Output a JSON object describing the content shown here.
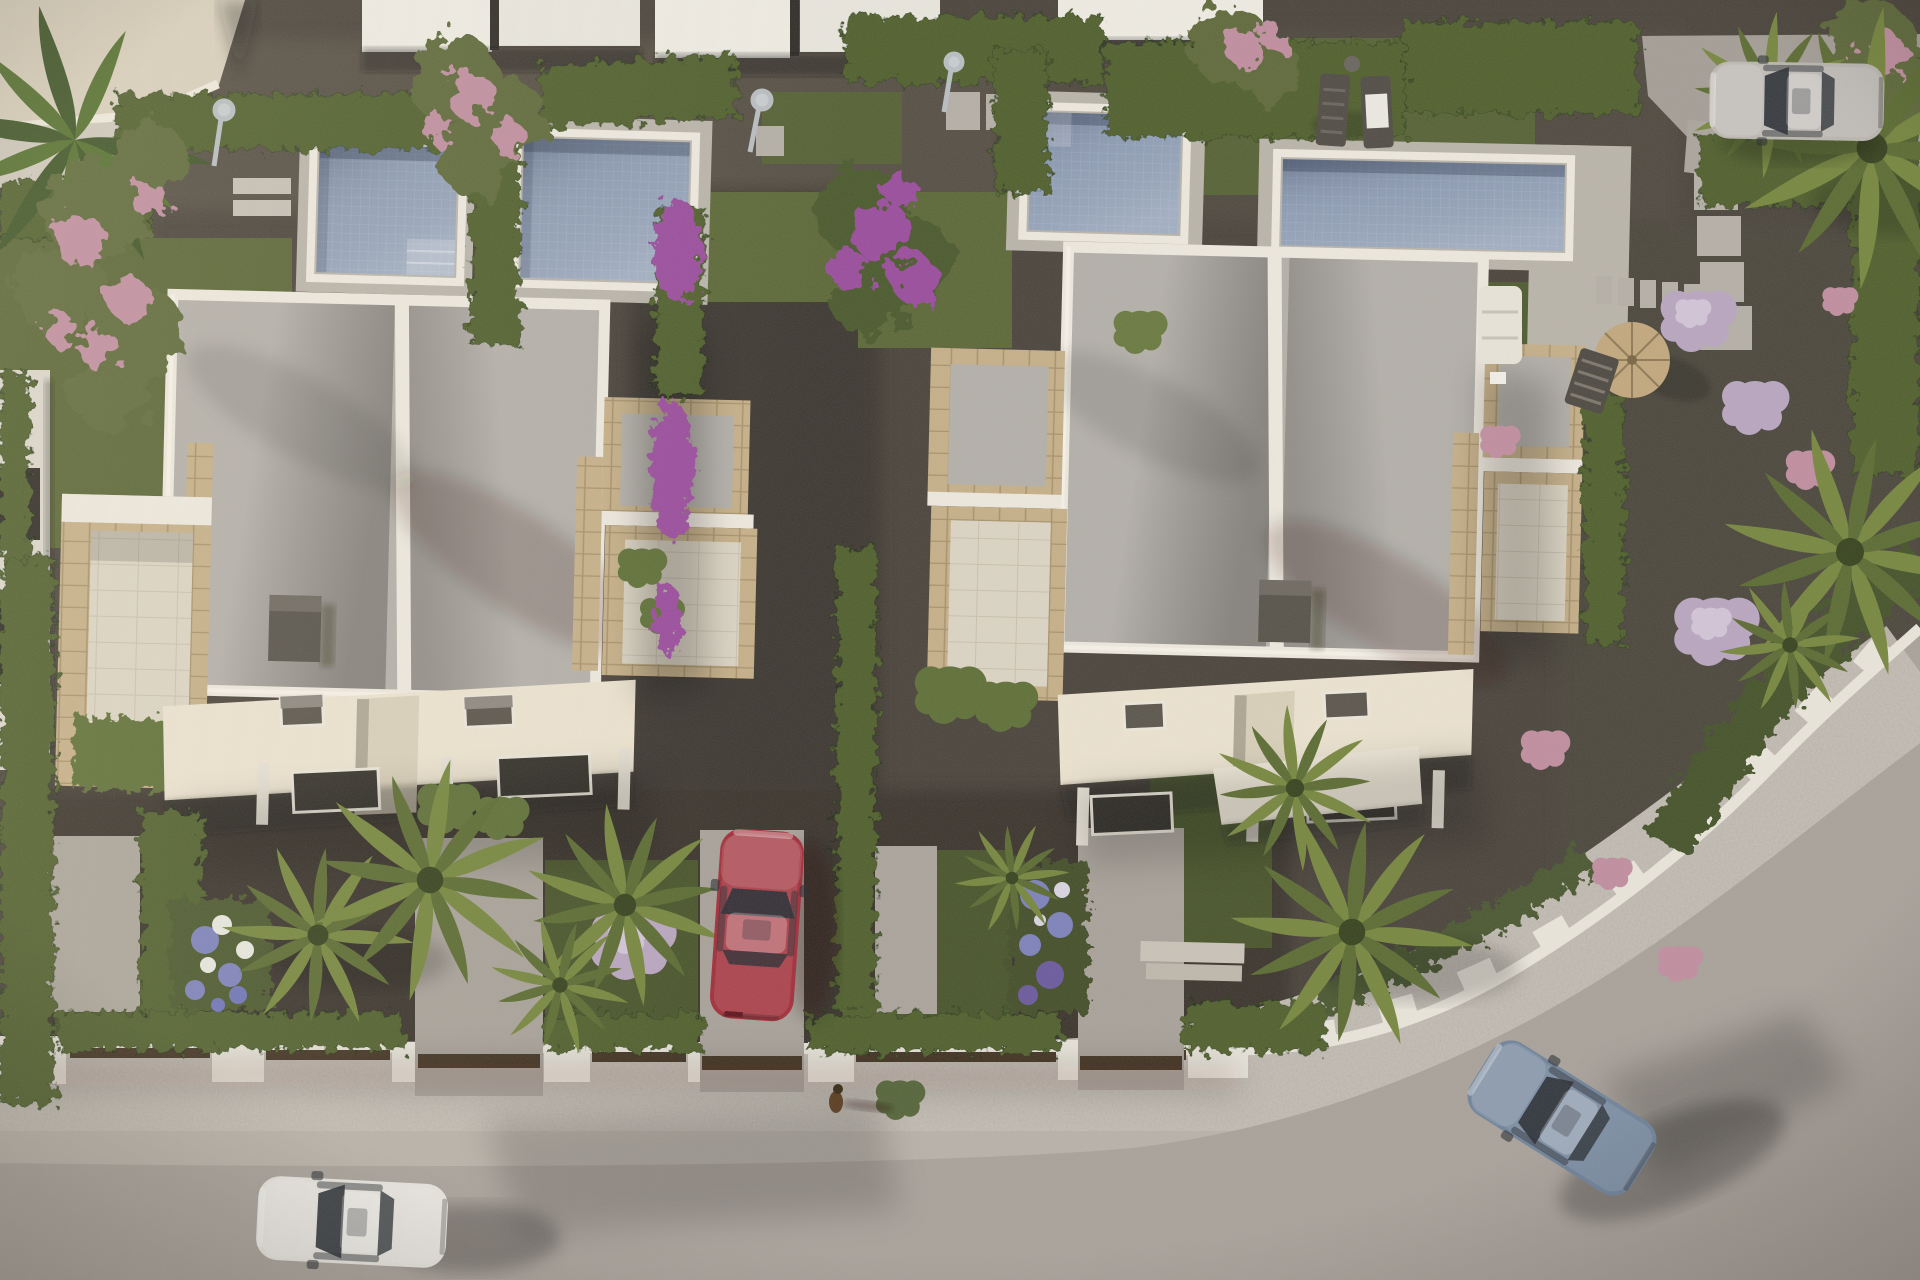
{
  "scene": {
    "title": "Aerial top-down 3D render of a modern villa development",
    "description": "Bird's-eye architectural rendering: two white duplex villas with flat gravel roofs, four swimming pools, Mediterranean gardens, parked cars, and a curved road with sidewalk along the bottom and right",
    "objects": {
      "villas": [
        "left duplex villa",
        "right duplex villa"
      ],
      "pools": [
        "pool-1",
        "pool-2",
        "pool-3",
        "pool-4"
      ],
      "cars": [
        {
          "id": "white-car",
          "location": "road bottom left",
          "color": "#e9e6e0"
        },
        {
          "id": "red-car",
          "location": "center driveway",
          "color": "#a32f3a"
        },
        {
          "id": "blue-car",
          "location": "road bottom right",
          "color": "#70839b"
        },
        {
          "id": "silver-car",
          "location": "top right driveway",
          "color": "#bab6b0"
        }
      ],
      "furniture": [
        "sun loungers",
        "wicker parasol",
        "deck chair",
        "garden sofa",
        "stepping stones",
        "outdoor showers"
      ],
      "landscape": [
        "cypress hedges",
        "fan palms",
        "banana plant",
        "bougainvillea",
        "pink flowering trees",
        "hydrangea beds",
        "gravel gardens",
        "lawns"
      ],
      "street": [
        "curved road",
        "speckled sidewalk",
        "white boundary wall",
        "dark timber gates"
      ],
      "figures": [
        "small dog on sidewalk"
      ]
    }
  },
  "palette": {
    "gravel_base": "#4a443c",
    "gravel_light": "#57504546",
    "gravel_path": "#3e3932",
    "road": "#a9a29b",
    "sidewalk": "#b8b2a9",
    "wall_white": "#e9e5db",
    "roof_gravel": "#b4b0aa",
    "parapet_white": "#eee9df",
    "cream_slab": "#ece3d0",
    "travertine": "#dcd5c5",
    "sandstone": "#c6b089",
    "pool_deck": "#bab5ab",
    "pool_water": "#8d9cb4",
    "grass": "#5a6636",
    "grass_dark": "#49552c",
    "hedge_green": "#51602f",
    "palm_green": "#77873f",
    "white_car": "#e9e6e0",
    "red_car": "#a32f3a",
    "blue_car": "#70839b",
    "silver_car": "#bab6b0",
    "gate_brown": "#463625",
    "flower_purple": "#9a4d9d",
    "flower_pink": "#c08ea0",
    "flower_lilac": "#b9a6c0",
    "flower_blue": "#7d82bb",
    "chimney_grey": "#57534b"
  }
}
